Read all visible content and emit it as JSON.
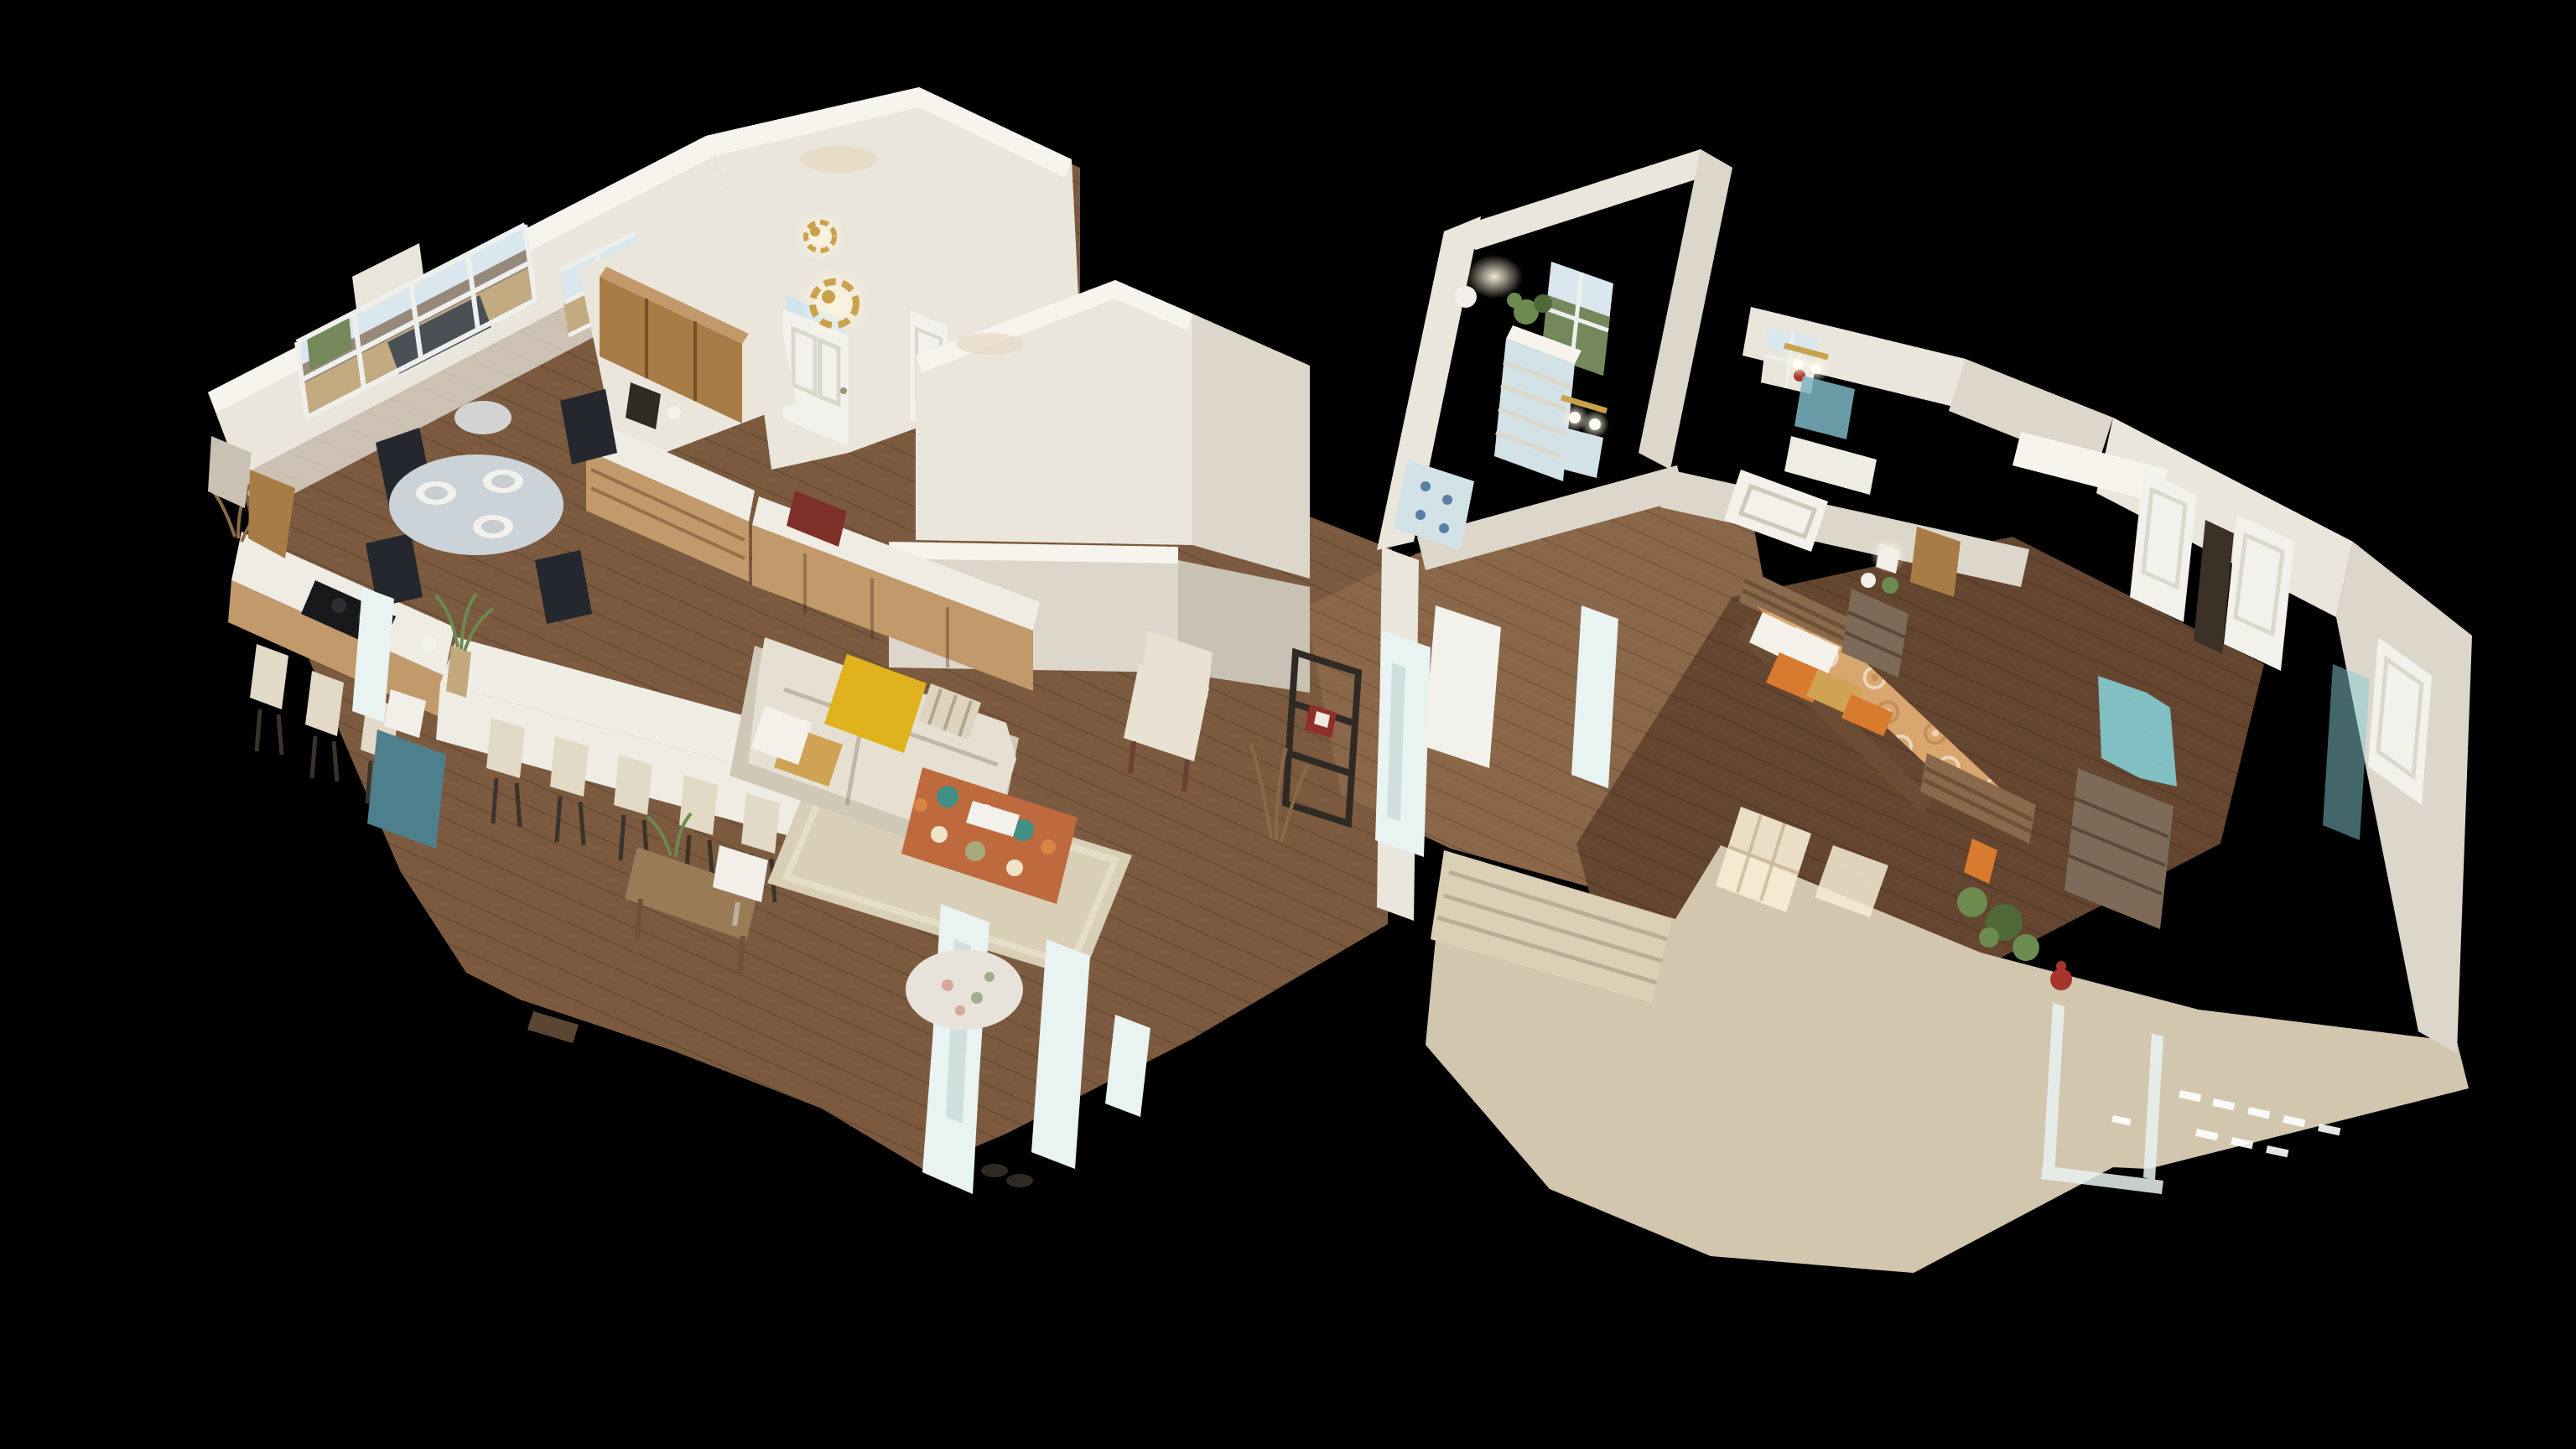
{
  "view": {
    "type": "dollhouse-3d",
    "description": "3D dollhouse cutaway view of a single-story home interior scanned in 3D, shown floating on a black background. Open-plan kitchen, dining nook and living room on the left; foyer and stairwell in the center; bedrooms, bathrooms and a large carpeted area on the right. Cut wall tops and pale scan artifacts are visible."
  },
  "scene": {
    "background": "#000000",
    "rooms": [
      {
        "id": "kitchen",
        "label": "Kitchen"
      },
      {
        "id": "dining-nook",
        "label": "Dining nook with bay window"
      },
      {
        "id": "living-room",
        "label": "Living room"
      },
      {
        "id": "foyer",
        "label": "Foyer / entry"
      },
      {
        "id": "stairwell",
        "label": "Stairwell"
      },
      {
        "id": "hallway",
        "label": "Hallway"
      },
      {
        "id": "secondary-bedroom",
        "label": "Secondary bedroom"
      },
      {
        "id": "bathrooms",
        "label": "Bathrooms"
      },
      {
        "id": "master-bedroom",
        "label": "Master bedroom"
      },
      {
        "id": "carpeted-area",
        "label": "Carpeted sitting area"
      }
    ],
    "counts": {
      "island_bar_stools": 5,
      "peninsula_stools": 3,
      "dining_chairs": 4,
      "table_place_settings": 3,
      "closet_doors_right_wall": 3
    }
  },
  "colors": {
    "background": "#000000",
    "wall_lit": "#ebe6dc",
    "wall_mid": "#ddd6ca",
    "wall_shadow": "#c9c2b4",
    "wall_cut_edge": "#f7f4ee",
    "wall_warm": "#e7d9c4",
    "floor_wood_main": "#7b5a3f",
    "floor_wood_dark": "#64452f",
    "floor_wood_hall": "#8a6749",
    "carpet": "#d2c6ae",
    "carpet_stairs": "#dbcfb6",
    "stair_shadow": "#b9ad97",
    "cabinet_wood": "#a87c45",
    "cabinet_wood_light": "#c2996a",
    "counter_white": "#efece4",
    "island_white": "#f0ede5",
    "stool_cream": "#e2d9c6",
    "chair_black": "#24272d",
    "table_top": "#ccd3d8",
    "plate_white": "#f2f1ec",
    "sofa_cream": "#e5e0d2",
    "sofa_shadow": "#cfc8b7",
    "throw_yellow": "#e0b31e",
    "pillow_tan": "#cfa254",
    "pillow_stripe": "#ddd3bf",
    "ottoman_base": "#bf6a3e",
    "ottoman_teal": "#3f8f85",
    "ottoman_cream": "#efe3c8",
    "rug_beige": "#d9cfb6",
    "armchair_cream": "#e9e2d2",
    "door_white": "#f3f1ec",
    "door_panel": "#dcd7cb",
    "door_glass": "#cfe4ee",
    "doorway_dark": "#3b3126",
    "window_frame": "#f6f4ef",
    "outside_ground": "#c4aa80",
    "outside_road": "#97897a",
    "outside_house": "#e9e5da",
    "outside_green": "#74885c",
    "outside_sky": "#dbe7ee",
    "car_gray": "#4b5057",
    "gold_fixture": "#c9a24b",
    "glow_warm": "#fff3d2",
    "bed_frame_wood": "#8a6a4c",
    "bed_frame_dark": "#6e5237",
    "bedspread": "#d9a670",
    "pillow_white": "#f4f1ea",
    "pillow_orange": "#d97b2e",
    "nightstand_wood": "#7d6a58",
    "dresser_blue_white": "#d3e2e6",
    "teal_artifact": "#85ccd4",
    "teal_cabinet": "#4d7f8c",
    "plant_green": "#6d8a4f",
    "plant_dark": "#4f6a38",
    "red_accent": "#a8342b",
    "doormat_red": "#7e2f28",
    "artifact_pale": "#e9f3f2",
    "artifact_shadow": "#cfe0df",
    "metal_dark": "#2f2a24",
    "frame_red": "#8e2f28",
    "lamp_white": "#f1efe8",
    "console_wood": "#9a7b55",
    "sun_patch": "#f6ecd4",
    "mirror_blue": "#7db5c2",
    "tub_white": "#f3f1ea",
    "pendant_silver": "#d8dadb"
  }
}
